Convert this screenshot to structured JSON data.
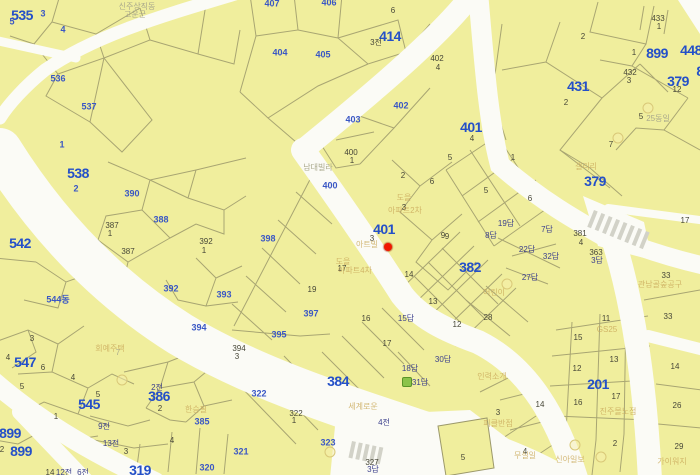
{
  "map": {
    "colors": {
      "parcel_fill": "#f0ee9d",
      "road": "#fbfbf6",
      "parcel_line": "#9c996b",
      "bold_label": "#2450c8",
      "blue_label": "#3a57c4",
      "dark_label": "#474738",
      "marker": "#f01800",
      "crosswalk": "#d2d2c8",
      "green_icon": "#8bc34a"
    },
    "marker": {
      "x": 388,
      "y": 247,
      "parcel": "401"
    },
    "labels": [
      [
        "535",
        22,
        15,
        "b"
      ],
      [
        "538",
        78,
        173,
        "b"
      ],
      [
        "542",
        20,
        243,
        "b"
      ],
      [
        "547",
        25,
        362,
        "b"
      ],
      [
        "545",
        89,
        404,
        "b"
      ],
      [
        "899",
        10,
        433,
        "b"
      ],
      [
        "899",
        21,
        451,
        "b"
      ],
      [
        "386",
        159,
        396,
        "b"
      ],
      [
        "319",
        140,
        470,
        "b"
      ],
      [
        "384",
        338,
        381,
        "b"
      ],
      [
        "414",
        390,
        36,
        "b"
      ],
      [
        "401",
        384,
        229,
        "b"
      ],
      [
        "401",
        471,
        127,
        "b"
      ],
      [
        "431",
        578,
        86,
        "b"
      ],
      [
        "899",
        657,
        53,
        "b"
      ],
      [
        "448",
        691,
        50,
        "b"
      ],
      [
        "379",
        678,
        81,
        "b"
      ],
      [
        "379",
        595,
        181,
        "b"
      ],
      [
        "382",
        470,
        267,
        "b"
      ],
      [
        "201",
        598,
        384,
        "b"
      ],
      [
        "8",
        700,
        71,
        "b"
      ],
      [
        "3",
        43,
        14,
        "n"
      ],
      [
        "5",
        12,
        22,
        "n"
      ],
      [
        "4",
        63,
        30,
        "n"
      ],
      [
        "536",
        58,
        79,
        "n"
      ],
      [
        "537",
        89,
        107,
        "n"
      ],
      [
        "1",
        62,
        145,
        "n"
      ],
      [
        "2",
        76,
        189,
        "n"
      ],
      [
        "390",
        132,
        194,
        "n"
      ],
      [
        "388",
        161,
        220,
        "n"
      ],
      [
        "392",
        171,
        289,
        "n"
      ],
      [
        "544동",
        58,
        300,
        "n"
      ],
      [
        "393",
        224,
        295,
        "n"
      ],
      [
        "398",
        268,
        239,
        "n"
      ],
      [
        "400",
        330,
        186,
        "n"
      ],
      [
        "403",
        353,
        120,
        "n"
      ],
      [
        "402",
        401,
        106,
        "n"
      ],
      [
        "404",
        280,
        53,
        "n"
      ],
      [
        "405",
        323,
        55,
        "n"
      ],
      [
        "407",
        272,
        4,
        "n"
      ],
      [
        "406",
        329,
        3,
        "n"
      ],
      [
        "397",
        311,
        314,
        "n"
      ],
      [
        "395",
        279,
        335,
        "n"
      ],
      [
        "394",
        199,
        328,
        "n"
      ],
      [
        "322",
        259,
        394,
        "n"
      ],
      [
        "323",
        328,
        443,
        "n"
      ],
      [
        "321",
        241,
        452,
        "n"
      ],
      [
        "385",
        202,
        422,
        "n"
      ],
      [
        "320",
        207,
        468,
        "n"
      ],
      [
        "6",
        393,
        11,
        "d"
      ],
      [
        "3전",
        376,
        43,
        "d"
      ],
      [
        "402",
        437,
        59,
        "d"
      ],
      [
        "4",
        438,
        68,
        "d"
      ],
      [
        "400",
        351,
        153,
        "d"
      ],
      [
        "1",
        352,
        161,
        "d"
      ],
      [
        "433",
        658,
        19,
        "d"
      ],
      [
        "1",
        659,
        27,
        "d"
      ],
      [
        "1",
        634,
        53,
        "d"
      ],
      [
        "432",
        630,
        73,
        "d"
      ],
      [
        "3",
        629,
        81,
        "d"
      ],
      [
        "12",
        677,
        90,
        "d"
      ],
      [
        "2",
        583,
        37,
        "d"
      ],
      [
        "2",
        566,
        103,
        "d"
      ],
      [
        "5",
        641,
        117,
        "d"
      ],
      [
        "7",
        611,
        145,
        "d"
      ],
      [
        "2",
        403,
        176,
        "d"
      ],
      [
        "6",
        432,
        182,
        "d"
      ],
      [
        "3",
        404,
        208,
        "d"
      ],
      [
        "3",
        372,
        239,
        "d"
      ],
      [
        "9",
        447,
        237,
        "d"
      ],
      [
        "17",
        342,
        269,
        "d"
      ],
      [
        "19",
        312,
        290,
        "d"
      ],
      [
        "394",
        239,
        349,
        "d"
      ],
      [
        "3",
        237,
        357,
        "d"
      ],
      [
        "16",
        366,
        319,
        "d"
      ],
      [
        "17",
        387,
        344,
        "d"
      ],
      [
        "12",
        457,
        325,
        "d"
      ],
      [
        "14",
        409,
        275,
        "d"
      ],
      [
        "13",
        433,
        302,
        "d"
      ],
      [
        "28",
        488,
        318,
        "d"
      ],
      [
        "9",
        443,
        236,
        "d"
      ],
      [
        "5",
        450,
        158,
        "d"
      ],
      [
        "1",
        513,
        158,
        "d"
      ],
      [
        "5",
        486,
        191,
        "d"
      ],
      [
        "6",
        530,
        199,
        "d"
      ],
      [
        "381",
        580,
        234,
        "d"
      ],
      [
        "4",
        581,
        243,
        "d"
      ],
      [
        "363",
        596,
        253,
        "d"
      ],
      [
        "4",
        472,
        139,
        "d"
      ],
      [
        "17",
        685,
        221,
        "d"
      ],
      [
        "33",
        666,
        276,
        "d"
      ],
      [
        "33",
        668,
        317,
        "d"
      ],
      [
        "322",
        296,
        414,
        "d"
      ],
      [
        "1",
        294,
        421,
        "d"
      ],
      [
        "327",
        372,
        463,
        "d"
      ],
      [
        "5",
        463,
        458,
        "d"
      ],
      [
        "3",
        32,
        339,
        "d"
      ],
      [
        "4",
        8,
        358,
        "d"
      ],
      [
        "6",
        43,
        368,
        "d"
      ],
      [
        "5",
        22,
        387,
        "d"
      ],
      [
        "4",
        73,
        378,
        "d"
      ],
      [
        "5",
        98,
        395,
        "d"
      ],
      [
        "1",
        56,
        417,
        "d"
      ],
      [
        "2",
        2,
        450,
        "d"
      ],
      [
        "2",
        160,
        409,
        "d"
      ],
      [
        "4",
        172,
        441,
        "d"
      ],
      [
        "3",
        126,
        452,
        "d"
      ],
      [
        "14",
        50,
        473,
        "d"
      ],
      [
        "11",
        606,
        319,
        "d"
      ],
      [
        "15",
        578,
        338,
        "d"
      ],
      [
        "13",
        614,
        360,
        "d"
      ],
      [
        "12",
        577,
        369,
        "d"
      ],
      [
        "17",
        616,
        397,
        "d"
      ],
      [
        "16",
        578,
        403,
        "d"
      ],
      [
        "14",
        540,
        405,
        "d"
      ],
      [
        "2",
        615,
        444,
        "d"
      ],
      [
        "4",
        525,
        452,
        "d"
      ],
      [
        "3",
        498,
        413,
        "d"
      ],
      [
        "14",
        675,
        367,
        "d"
      ],
      [
        "26",
        677,
        406,
        "d"
      ],
      [
        "29",
        679,
        447,
        "d"
      ],
      [
        "387",
        112,
        226,
        "d"
      ],
      [
        "1",
        110,
        234,
        "d"
      ],
      [
        "387",
        128,
        252,
        "d"
      ],
      [
        "392",
        206,
        242,
        "d"
      ],
      [
        "1",
        204,
        251,
        "d"
      ],
      [
        "15답",
        406,
        319,
        "s"
      ],
      [
        "18답",
        410,
        369,
        "s"
      ],
      [
        "30답",
        443,
        360,
        "s"
      ],
      [
        "31답",
        420,
        383,
        "s"
      ],
      [
        "19답",
        506,
        224,
        "s"
      ],
      [
        "7답",
        547,
        230,
        "s"
      ],
      [
        "8답",
        491,
        236,
        "s"
      ],
      [
        "22답",
        527,
        250,
        "s"
      ],
      [
        "32답",
        551,
        257,
        "s"
      ],
      [
        "27답",
        530,
        278,
        "s"
      ],
      [
        "3답",
        597,
        261,
        "s"
      ],
      [
        "3답",
        373,
        470,
        "s"
      ],
      [
        "4전",
        384,
        423,
        "s"
      ],
      [
        "2전",
        157,
        388,
        "s"
      ],
      [
        "9전",
        104,
        427,
        "s"
      ],
      [
        "13전",
        111,
        444,
        "s"
      ],
      [
        "6전",
        83,
        473,
        "s"
      ],
      [
        "12전",
        64,
        473,
        "s"
      ],
      [
        "신주상직동",
        137,
        7,
        "fg"
      ],
      [
        "고운군",
        135,
        15,
        "fg"
      ],
      [
        "남대빌라",
        318,
        168,
        "fg"
      ],
      [
        "25동일",
        658,
        119,
        "fg"
      ],
      [
        "7",
        118,
        353,
        "fg"
      ],
      [
        "도을",
        404,
        198,
        "fo"
      ],
      [
        "아파트2차",
        405,
        211,
        "fo"
      ],
      [
        "아트빌",
        367,
        245,
        "fo"
      ],
      [
        "도을",
        343,
        262,
        "fo"
      ],
      [
        "아파트4차",
        355,
        271,
        "fo"
      ],
      [
        "세계로운",
        363,
        407,
        "fo"
      ],
      [
        "회예주택",
        110,
        349,
        "fo"
      ],
      [
        "한승필",
        196,
        410,
        "fo"
      ],
      [
        "GS25",
        607,
        330,
        "fo"
      ],
      [
        "피클반점",
        498,
        424,
        "fo"
      ],
      [
        "인력소개",
        492,
        377,
        "fo"
      ],
      [
        "진주몰노점",
        618,
        412,
        "fo"
      ],
      [
        "무실일",
        525,
        456,
        "fo"
      ],
      [
        "신아일보",
        570,
        460,
        "fo"
      ],
      [
        "가이워지",
        672,
        462,
        "fo"
      ],
      [
        "관남골숲공구",
        660,
        285,
        "fo"
      ],
      [
        "갤리리",
        586,
        167,
        "fo"
      ],
      [
        "어린이",
        494,
        293,
        "fo"
      ]
    ],
    "poi_circles": [
      [
        648,
        108
      ],
      [
        618,
        138
      ],
      [
        575,
        445
      ],
      [
        601,
        457
      ],
      [
        330,
        452
      ],
      [
        122,
        380
      ],
      [
        507,
        284
      ]
    ],
    "green_icons": [
      [
        407,
        382
      ]
    ]
  }
}
